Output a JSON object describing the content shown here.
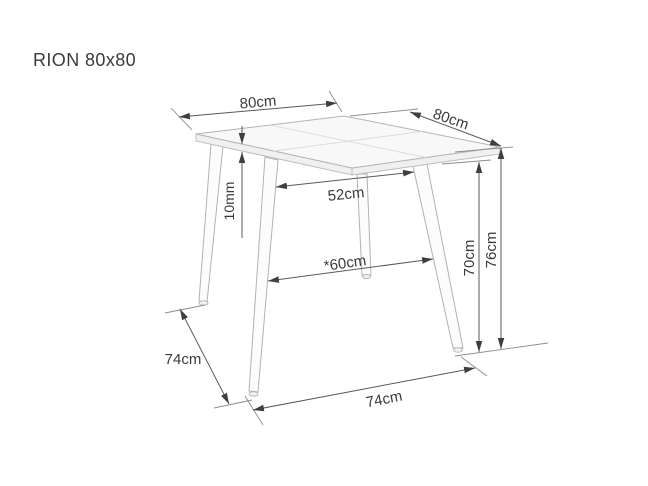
{
  "title": "RION 80x80",
  "dimensions": {
    "top_width": "80cm",
    "top_depth": "80cm",
    "top_thickness": "10mm",
    "leg_gap_top": "52cm",
    "leg_gap_wide": "*60cm",
    "height_to_underside": "70cm",
    "height_total": "76cm",
    "feet_span_side": "74cm",
    "feet_span_front": "74cm"
  },
  "colors": {
    "background": "#ffffff",
    "dimension_line": "#5a5a5a",
    "table_outline": "#b5b5b5",
    "table_fill": "#f8f8f8",
    "text": "#3a3a3a"
  }
}
